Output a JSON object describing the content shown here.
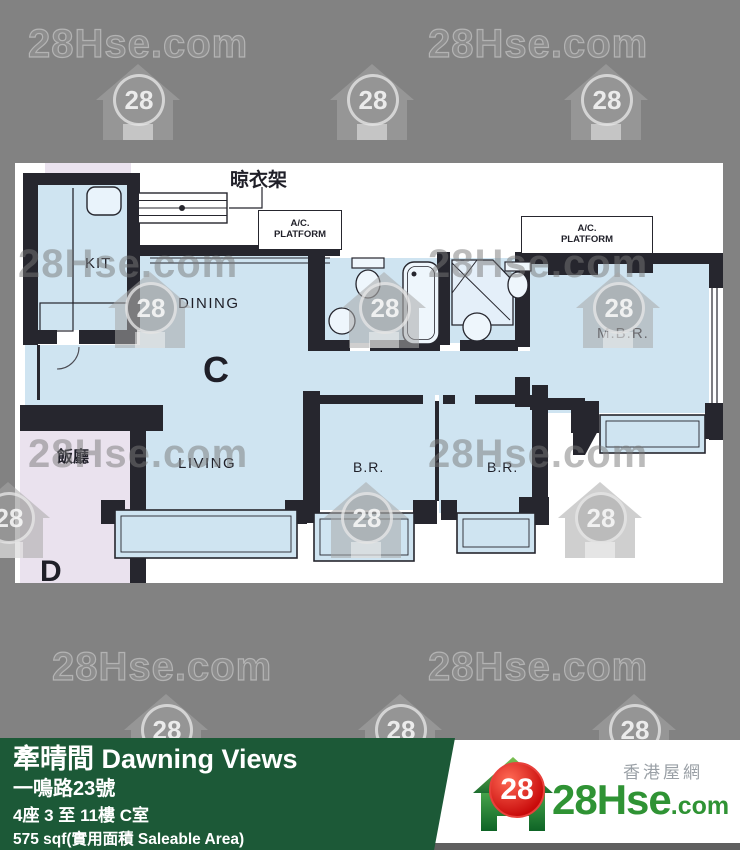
{
  "colors": {
    "background": "#828282",
    "plan_background": "#ffffff",
    "floor_blue": "#cfe4f1",
    "wall_dark": "#26262e",
    "adjacent_floor_pink": "#eae2ee",
    "info_bar_green": "#1c5937",
    "logo_green": "#2f9334",
    "badge_red": "#c80a0a"
  },
  "watermark": {
    "text": "28Hse.com",
    "badge": "28"
  },
  "floorplan": {
    "unit_label": "C",
    "adjacent_unit_label": "D",
    "rooms": {
      "kitchen": "KIT",
      "dining": "DINING",
      "living": "LIVING",
      "bedroom1": "B.R.",
      "bedroom2": "B.R.",
      "master_bedroom": "M.B.R.",
      "bath1": "B.",
      "bath2": "B.",
      "adjacent_dining": "飯廳"
    },
    "annotations": {
      "drying_rack": "晾衣架",
      "ac_line1": "A/C.",
      "ac_line2": "PLATFORM"
    }
  },
  "info_bar": {
    "title": "牽晴間 Dawning Views",
    "address": "一鳴路23號",
    "block_floor": "4座 3 至 11樓 C室",
    "area": "575 sqf(實用面積 Saleable Area)"
  },
  "logo": {
    "tagline": "香港屋網",
    "brand": "28Hse",
    "suffix": ".com",
    "badge": "28"
  }
}
